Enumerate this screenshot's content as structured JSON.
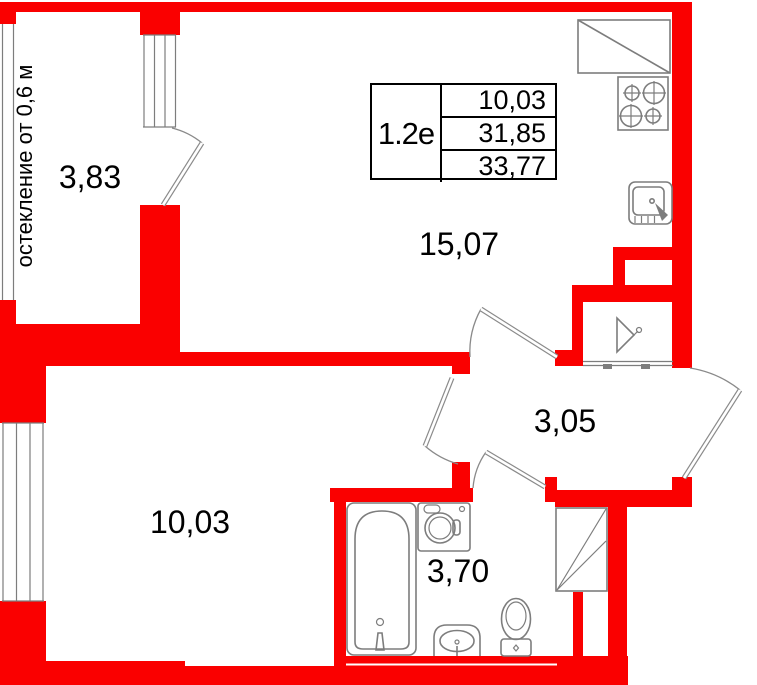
{
  "unit": {
    "label": "1.2е",
    "areas": [
      "10,03",
      "31,85",
      "33,77"
    ]
  },
  "rooms": {
    "balcony": "3,83",
    "living_kitchen": "15,07",
    "bedroom": "10,03",
    "hallway": "3,05",
    "bathroom": "3,70"
  },
  "notes": {
    "glazing": "остекление от 0,6 м"
  },
  "colors": {
    "wall": "#fa0000",
    "line": "#7d7d7d",
    "text": "#000000"
  }
}
